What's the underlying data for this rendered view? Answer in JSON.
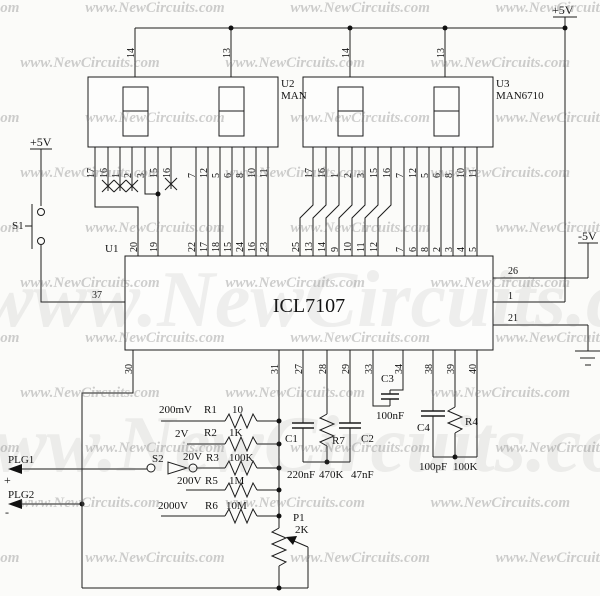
{
  "watermark": {
    "row_text": "www.NewCircuits.com www.NewCircuits.com www.NewCircuits.com www.NewCircuits.com www.NewCircuits.com",
    "big_text": "www.NewCircuits.com"
  },
  "power": {
    "vcc_left": "+5V",
    "vcc_right": "+5V",
    "vee": "-5V"
  },
  "displays": {
    "u2": {
      "ref": "U2",
      "part": "MAN",
      "top_pins": [
        "14",
        "13"
      ],
      "pins": [
        "17",
        "16",
        "1",
        "2",
        "3",
        "15",
        "16",
        "7",
        "12",
        "5",
        "6",
        "8",
        "10",
        "11"
      ]
    },
    "u3": {
      "ref": "U3",
      "part": "MAN6710",
      "top_pins": [
        "14",
        "13"
      ],
      "pins": [
        "17",
        "16",
        "1",
        "2",
        "3",
        "15",
        "16",
        "7",
        "12",
        "5",
        "6",
        "8",
        "10",
        "11"
      ]
    }
  },
  "u1": {
    "ref": "U1",
    "part": "ICL7107",
    "pin_in": "37",
    "top_pins": [
      "20",
      "19",
      "22",
      "17",
      "18",
      "15",
      "24",
      "16",
      "23",
      "25",
      "13",
      "14",
      "9",
      "10",
      "11",
      "12",
      "7",
      "6",
      "8",
      "2",
      "3",
      "4",
      "5"
    ],
    "right_pins": [
      "26",
      "1",
      "21"
    ],
    "bottom_pins": [
      "30",
      "31",
      "27",
      "28",
      "29",
      "33",
      "34",
      "38",
      "39",
      "40"
    ]
  },
  "input": {
    "s1": "S1",
    "s2": "S2",
    "plg1": "PLG1",
    "plg1_sign": "+",
    "plg2": "PLG2",
    "plg2_sign": "-"
  },
  "ranges": [
    {
      "label": "200mV",
      "ref": "R1",
      "value": "10"
    },
    {
      "label": "2V",
      "ref": "R2",
      "value": "1K"
    },
    {
      "label": "20V",
      "ref": "R3",
      "value": "100K"
    },
    {
      "label": "200V",
      "ref": "R5",
      "value": "1M"
    },
    {
      "label": "2000V",
      "ref": "R6",
      "value": "10M"
    }
  ],
  "parts": {
    "c1": {
      "ref": "C1",
      "value": "220nF"
    },
    "r7": {
      "ref": "R7",
      "value": "470K"
    },
    "c2": {
      "ref": "C2",
      "value": "47nF"
    },
    "c3": {
      "ref": "C3",
      "value": "100nF"
    },
    "c4": {
      "ref": "C4",
      "value": "100pF"
    },
    "r4": {
      "ref": "R4",
      "value": "100K"
    },
    "p1": {
      "ref": "P1",
      "value": "2K"
    }
  }
}
